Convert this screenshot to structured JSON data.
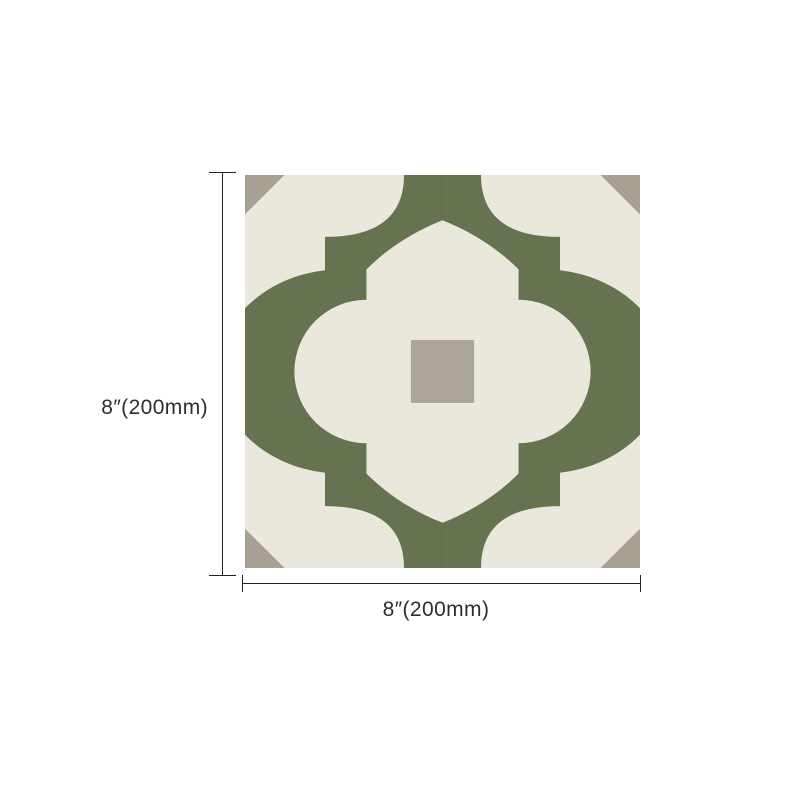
{
  "tile": {
    "name": "moroccan-lantern-pattern-tile",
    "colors": {
      "base_cream": "#eae8dc",
      "pattern_green": "#667351",
      "corner_gray": "#a8a193",
      "center_square_gray": "#aba59a",
      "seam_green": "#5d6b4b"
    }
  },
  "dimensions": {
    "height_label": "8″(200mm)",
    "width_label": "8″(200mm)",
    "line_color": "#222222",
    "text_color": "#2d2d2d"
  }
}
